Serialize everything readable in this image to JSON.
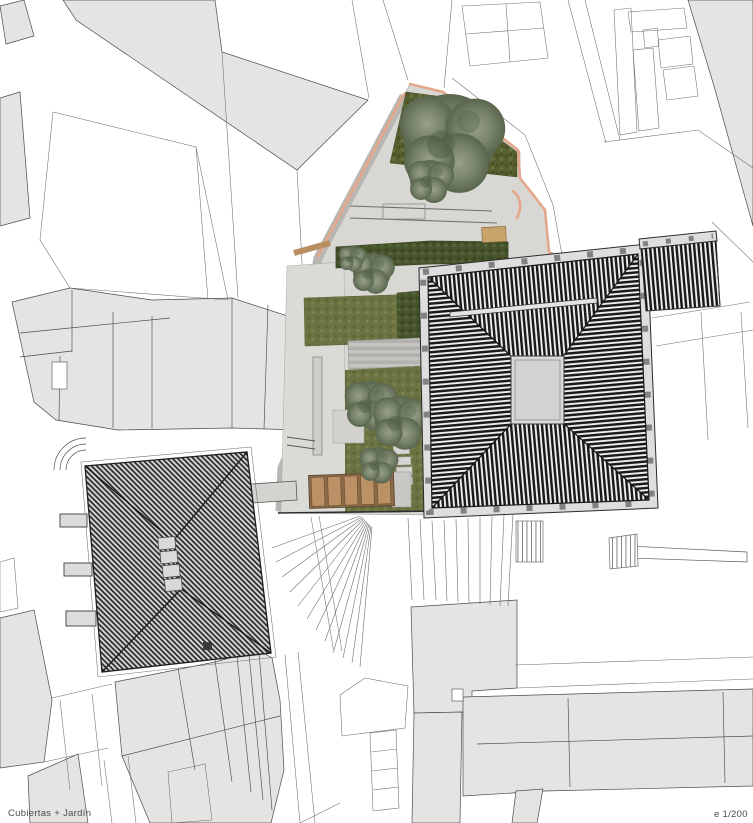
{
  "drawing": {
    "caption": "Cubiertas + Jardín",
    "scale_label": "e 1/200"
  },
  "palette": {
    "page_background": "#ffffff",
    "parcel_fill": "#e4e4e3",
    "parcel_outline": "#4b4b4b",
    "site_paving": "#d8d7d3",
    "paving_shadow": "#b7b6b2",
    "lawn_dark_green": "#575f31",
    "lawn_mid_green": "#6b7342",
    "hedge_green": "#46532c",
    "tree_gray_green": "#79846c",
    "wood_brown": "#b98e60",
    "boundary_wall_salmon": "#e5a78a",
    "roof_hatch_dark": "#1a1a1a",
    "roof_eaves_light": "#dedede",
    "roof_block_gray": "#818181",
    "skylight_gray": "#d9d9d8"
  }
}
